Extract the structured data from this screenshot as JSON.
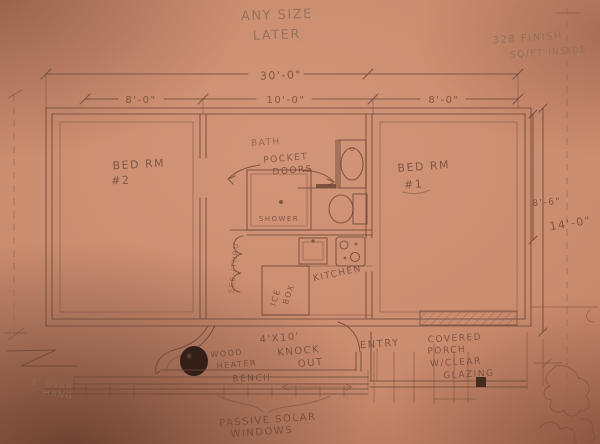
{
  "colors": {
    "paper": "#ca8c6f",
    "paper_edge": "#8a5340",
    "ink": "#6d4636",
    "graphite": "#8f6e58",
    "stove_fill": "#2a1913"
  },
  "notes": {
    "size_l1": "ANY SIZE",
    "size_l2": "LATER",
    "sqft_l1": "328 FINISH",
    "sqft_l2": "SQ/FT INSIDE",
    "overhang_l1": "2' OVER",
    "overhang_l2": "HANG",
    "passive_l1": "PASSIVE SOLAR",
    "passive_l2": "WINDOWS"
  },
  "dimensions": {
    "overall_width": "30'-0\"",
    "bay_left": "8'-0\"",
    "bay_mid": "10'-0\"",
    "bay_right": "8'-0\"",
    "right_inner": "8'-6\"",
    "overall_depth": "14'-0\""
  },
  "rooms": {
    "bed2_l1": "BED RM",
    "bed2_l2": "#2",
    "bed1_l1": "BED RM",
    "bed1_l2": "#1",
    "bath": "BATH",
    "pocket_l1": "POCKET",
    "pocket_l2": "DOORS",
    "shower": "SHOWER",
    "kitchen": "KITCHEN",
    "icebox_l1": "ICE",
    "icebox_l2": "BOX",
    "side_note": "SEE-/THRU",
    "knockout_l1": "4'X10'",
    "knockout_l2": "KNOCK",
    "knockout_l3": "OUT",
    "entry": "ENTRY",
    "heater_l1": "WOOD",
    "heater_l2": "HEATER",
    "bench": "BENCH",
    "porch_l1": "COVERED",
    "porch_l2": "PORCH",
    "porch_l3": "W/CLEAR",
    "porch_l4": "GLAZING"
  }
}
